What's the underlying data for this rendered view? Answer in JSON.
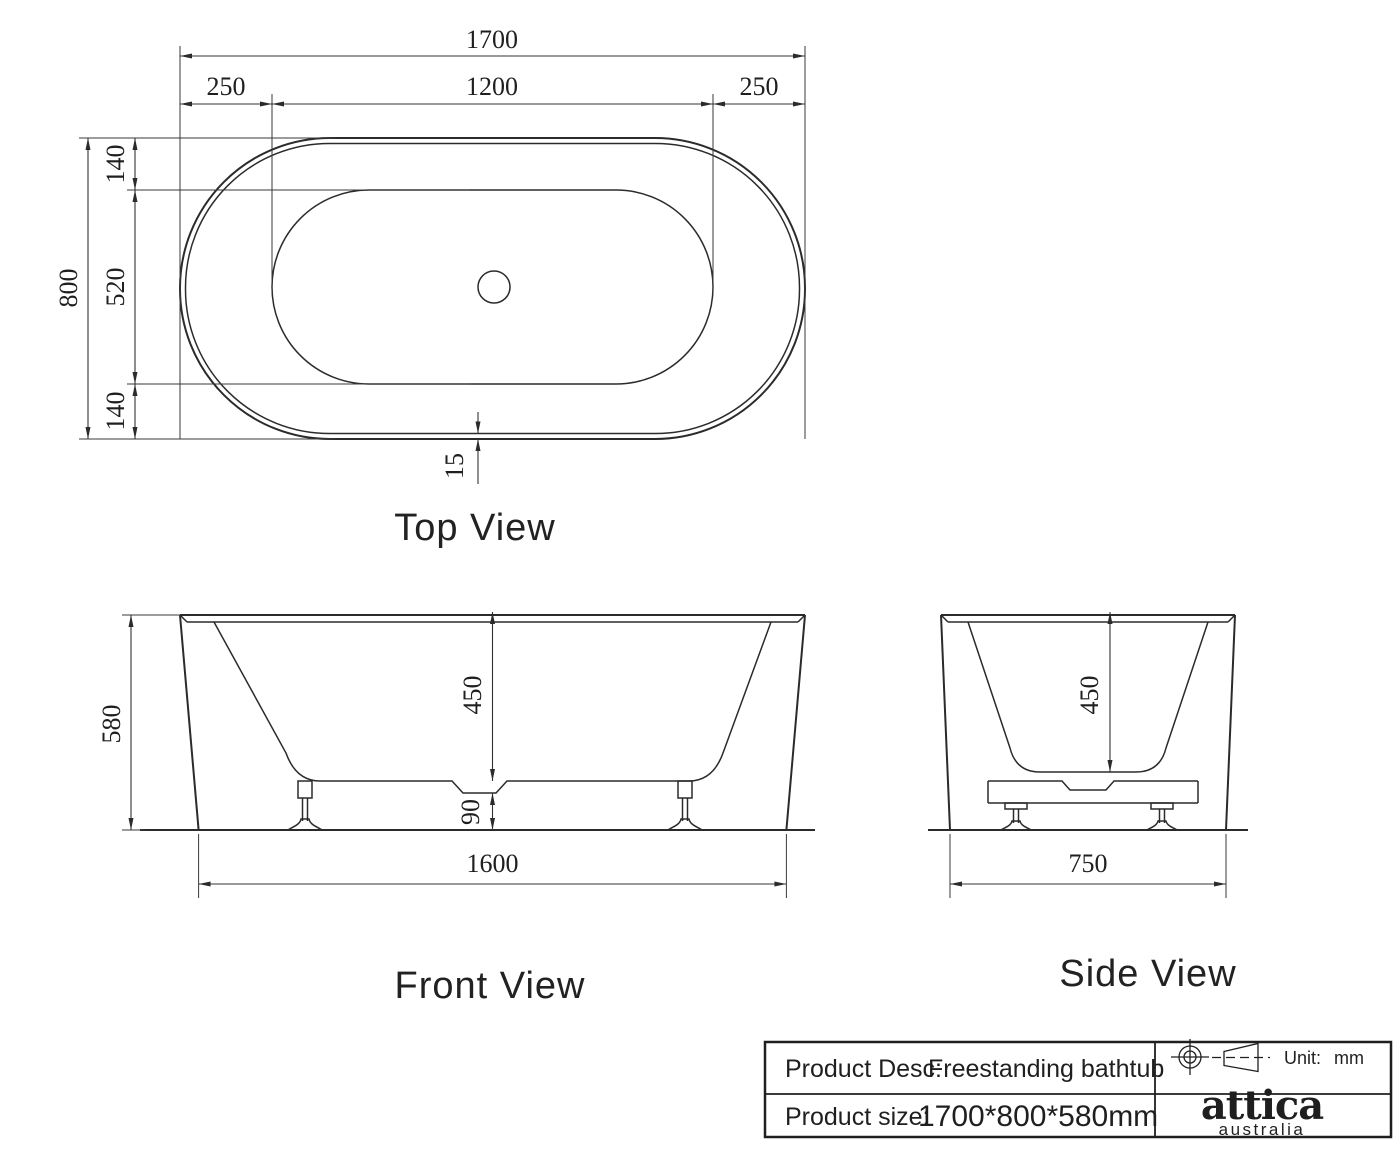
{
  "drawing_title": "Freestanding bathtub technical drawing",
  "colors": {
    "line": "#2b2b2b",
    "dim_line": "#333333",
    "text": "#1f1f1f",
    "background": "#ffffff"
  },
  "top_view": {
    "label": "Top View",
    "dims": {
      "overall_length": "1700",
      "left_offset": "250",
      "basin_length": "1200",
      "right_offset": "250",
      "overall_width": "800",
      "top_offset": "140",
      "basin_width": "520",
      "bottom_offset": "140",
      "wall_thickness": "15"
    }
  },
  "front_view": {
    "label": "Front View",
    "dims": {
      "overall_height": "580",
      "inner_depth": "450",
      "base_clearance": "90",
      "base_length": "1600"
    }
  },
  "side_view": {
    "label": "Side View",
    "dims": {
      "inner_depth": "450",
      "base_width": "750"
    }
  },
  "title_block": {
    "product_desc_label": "Product Desc:",
    "product_desc_value": "Freestanding bathtub",
    "product_size_label": "Product size:",
    "product_size_value": "1700*800*580mm",
    "unit_label": "Unit:",
    "unit_value": "mm",
    "logo_primary": "attica",
    "logo_secondary": "australia"
  },
  "icons": {
    "projection_circle": "first-angle-projection-target",
    "projection_cone": "first-angle-projection-cone"
  }
}
